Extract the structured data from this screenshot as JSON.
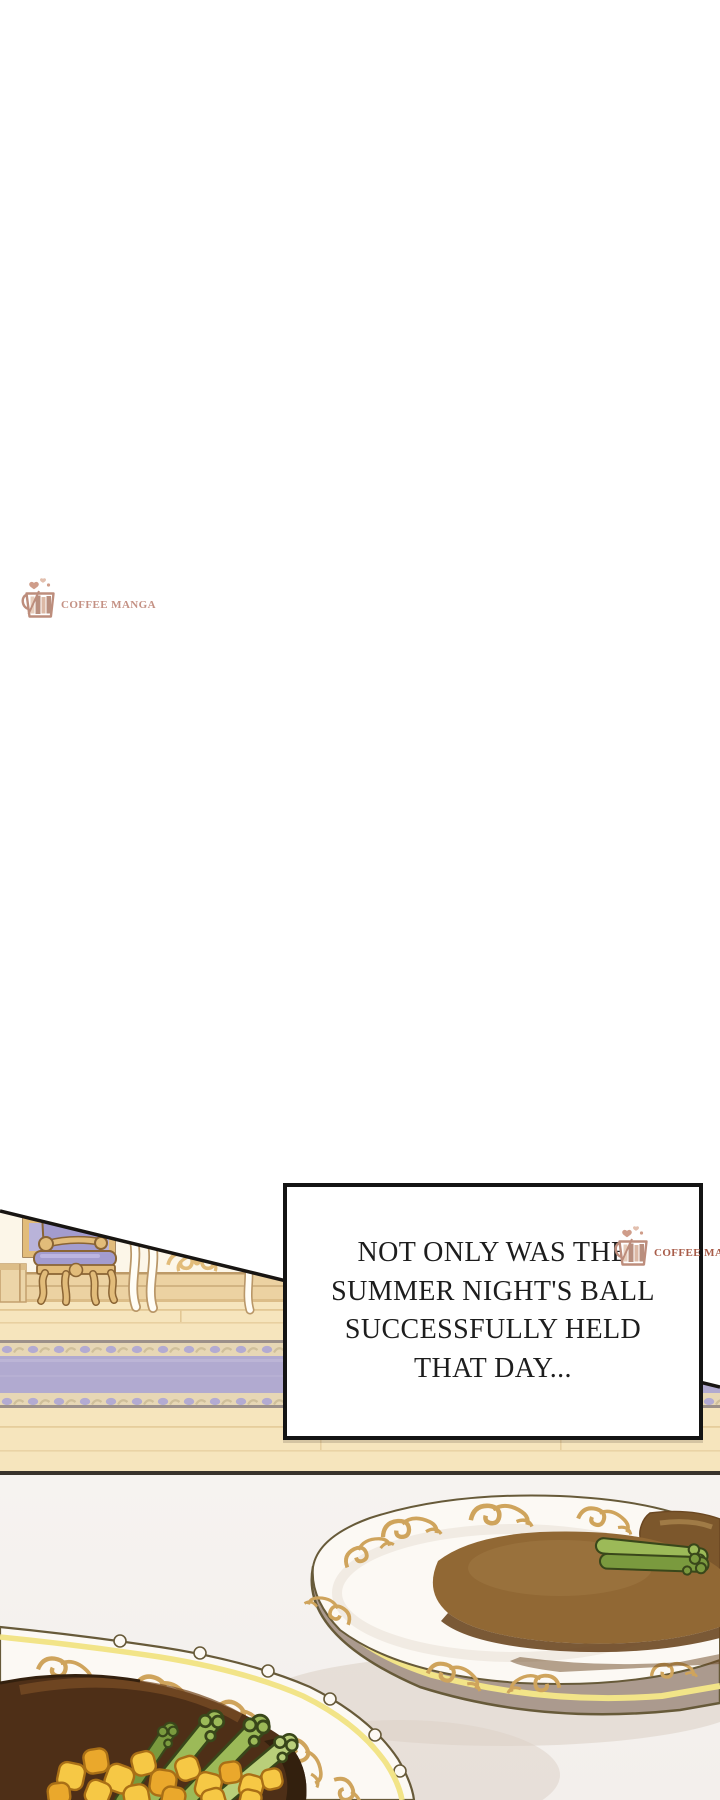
{
  "watermarks": {
    "top": {
      "brand": "COFFEE MANGA"
    },
    "box": {
      "brand": "COFFEE MANGA"
    },
    "icon": "coffee-mug-icon"
  },
  "narration": {
    "lines": [
      "NOT ONLY WAS THE",
      "SUMMER NIGHT'S BALL",
      "SUCCESSFULLY HELD",
      "THAT DAY..."
    ]
  },
  "colors": {
    "pageBg": "#ffffff",
    "ink": "#141414",
    "boxBg": "#ffffff",
    "brandTop": "#c49184",
    "brandBox": "#a85c49",
    "mug": "#bd8d7c",
    "bookA": "#e7cdbb",
    "bookB": "#b98f7e",
    "bookC": "#dcb9a5",
    "heart": "#cf9d8a",
    "heartLight": "#e2bfae",
    "wall": "#fcf6e8",
    "pedestal": "#ecd5a8",
    "pedestalLine": "#c3a06e",
    "baseboard": "#ecd2a2",
    "baseboardLine": "#bd9a67",
    "baseboardSoft": "#dcbd88",
    "floor": "#f6e5bd",
    "floorLine": "#e2c794",
    "carpet": "#b1aad0",
    "carpetLight": "#c3bddb",
    "carpetBand": "#e7d7b5",
    "carpetMotif": "#b3abd2",
    "carpetSwirl": "#cfbf9a",
    "carpetEdge": "#9c9089",
    "divider": "#39332c",
    "table": "#f3efec",
    "tableLight": "#f6f3f0",
    "tableShadow": "#dbd0c5",
    "plate": "#fcf9f4",
    "plateShade": "#eee7de",
    "plateSide": "#ab9a8e",
    "plateLine": "#675a39",
    "rimYellow": "#f2e488",
    "gold": "#cfa45c",
    "sauce": "#916834",
    "sauceDark": "#6b4721",
    "meat": "#7c572c",
    "meatLight": "#a9854e",
    "gravy": "#4e2f17",
    "gravyDark": "#33200e",
    "gravyLight": "#7a4e26",
    "asparagus": "#9cba58",
    "asparagusShade": "#7a9a3e",
    "asparagusLine": "#39471a",
    "asparagusTip": "#b9cf7a",
    "corn": "#f6c845",
    "cornShade": "#eaa82c",
    "cornLine": "#a96f16",
    "chairGold": "#e2bc7a",
    "chairLine": "#8a6434",
    "cushion": "#a39cce",
    "cushionLight": "#bcb5e0",
    "frameInner": "#b9b3d9",
    "white": "#fffdf6",
    "tableLegLine": "#b99768"
  }
}
